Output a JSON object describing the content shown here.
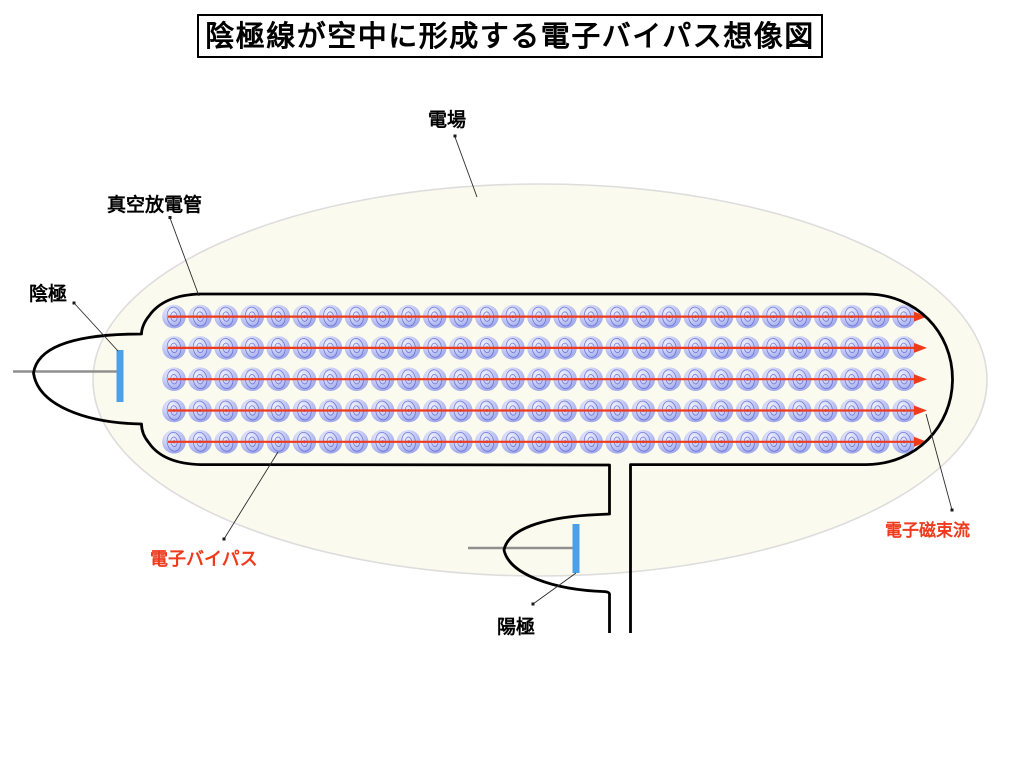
{
  "title": "陰極線が空中に形成する電子バイパス想像図",
  "labels": {
    "field": "電場",
    "tube": "真空放電管",
    "cathode": "陰極",
    "anode": "陽極",
    "bypass": "電子バイパス",
    "flux": "電子磁束流"
  },
  "colors": {
    "red_label": "#ee3b1e",
    "red_arrow": "#ee3b1e",
    "electrode_blue": "#4aa1e8",
    "field_fill": "#fbfaee",
    "field_stroke": "#dddddd",
    "tube_stroke": "#000000",
    "orbit_stroke": "#4953cc",
    "axis_gray": "#8f8f8f"
  },
  "electron_grid": {
    "rows": 5,
    "cols": 29
  }
}
